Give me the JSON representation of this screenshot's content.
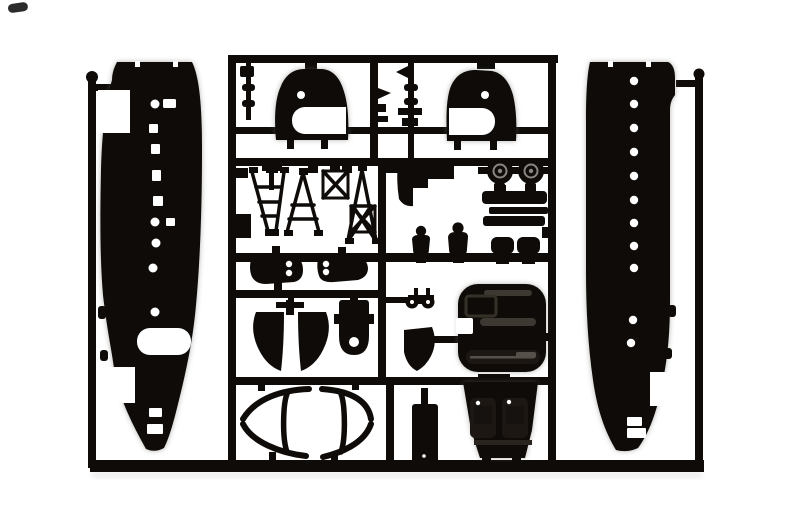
{
  "meta": {
    "scene": "photograph of a black injection-molded plastic model kit sprue (runner) with aircraft parts",
    "material": "black styrene plastic on white background"
  },
  "colors": {
    "background": "#ffffff",
    "plastic": "#0e0b08",
    "plastic_soft": "#1c1713",
    "detail_gray": "#3d3831",
    "detail_gray_light": "#56504a",
    "hub_gray": "#8a8580",
    "halo_gray": "#6b6763",
    "white": "#ffffff"
  },
  "parts": {
    "frame": "sprue runner frame",
    "left_runner": "left outer runner bar",
    "right_runner": "right outer runner bar",
    "fuselage_left": "left fuselage half with cabin windows and wing opening",
    "fuselage_right": "right fuselage half with porthole windows",
    "dome_left": "left cowling dome shell with porthole",
    "dome_right": "right cowling dome shell with porthole",
    "runner_bits": "small antenna and pitot parts on runner rods",
    "trusses": "ladder and truss frame parts",
    "pods": "pod halves with twin portholes",
    "keel": "split keel fairing part",
    "ring": "rounded part with circular opening",
    "winch": "twin-drum winch part",
    "flap": "curved cowl flap part",
    "cowling_front": "engine cowling front block with vents",
    "floor_seats": "cockpit floor part with two molded seats",
    "panel": "cabin door panel part",
    "wheels": "pair of main wheels",
    "exhausts": "stacked exhaust / step parts",
    "figures": "two pilot figure torsos",
    "seats_small": "two crew seat parts",
    "tailplane": "elliptical tailplane outline part",
    "mark": "small dark film mark"
  }
}
